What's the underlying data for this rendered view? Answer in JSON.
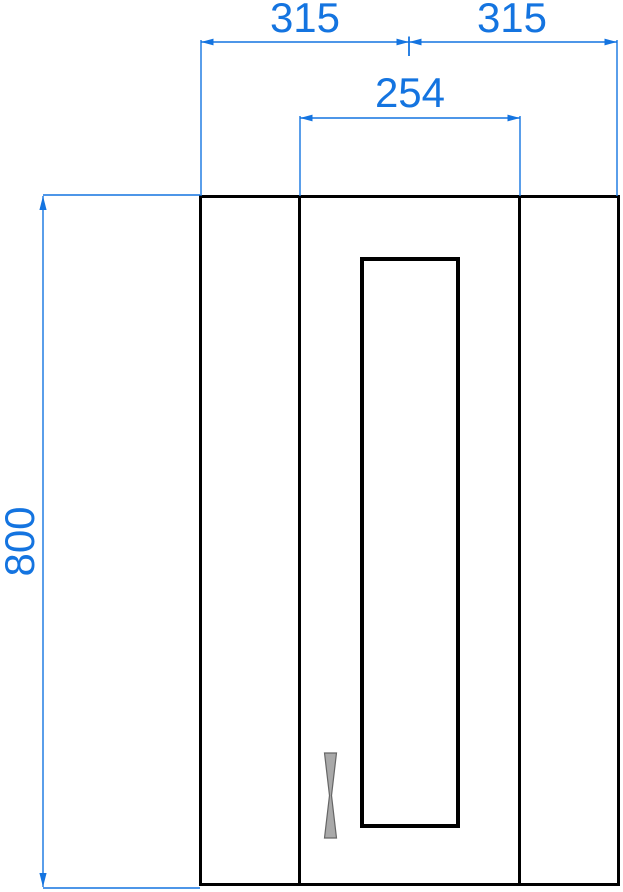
{
  "dimensions": {
    "top_left_width": "315",
    "top_right_width": "315",
    "door_width": "254",
    "height": "800"
  },
  "colors": {
    "dimension": "#1474e0",
    "outline": "#000000",
    "handle-fill": "#a9a9a9",
    "handle-stroke": "#666666",
    "background": "#ffffff"
  }
}
